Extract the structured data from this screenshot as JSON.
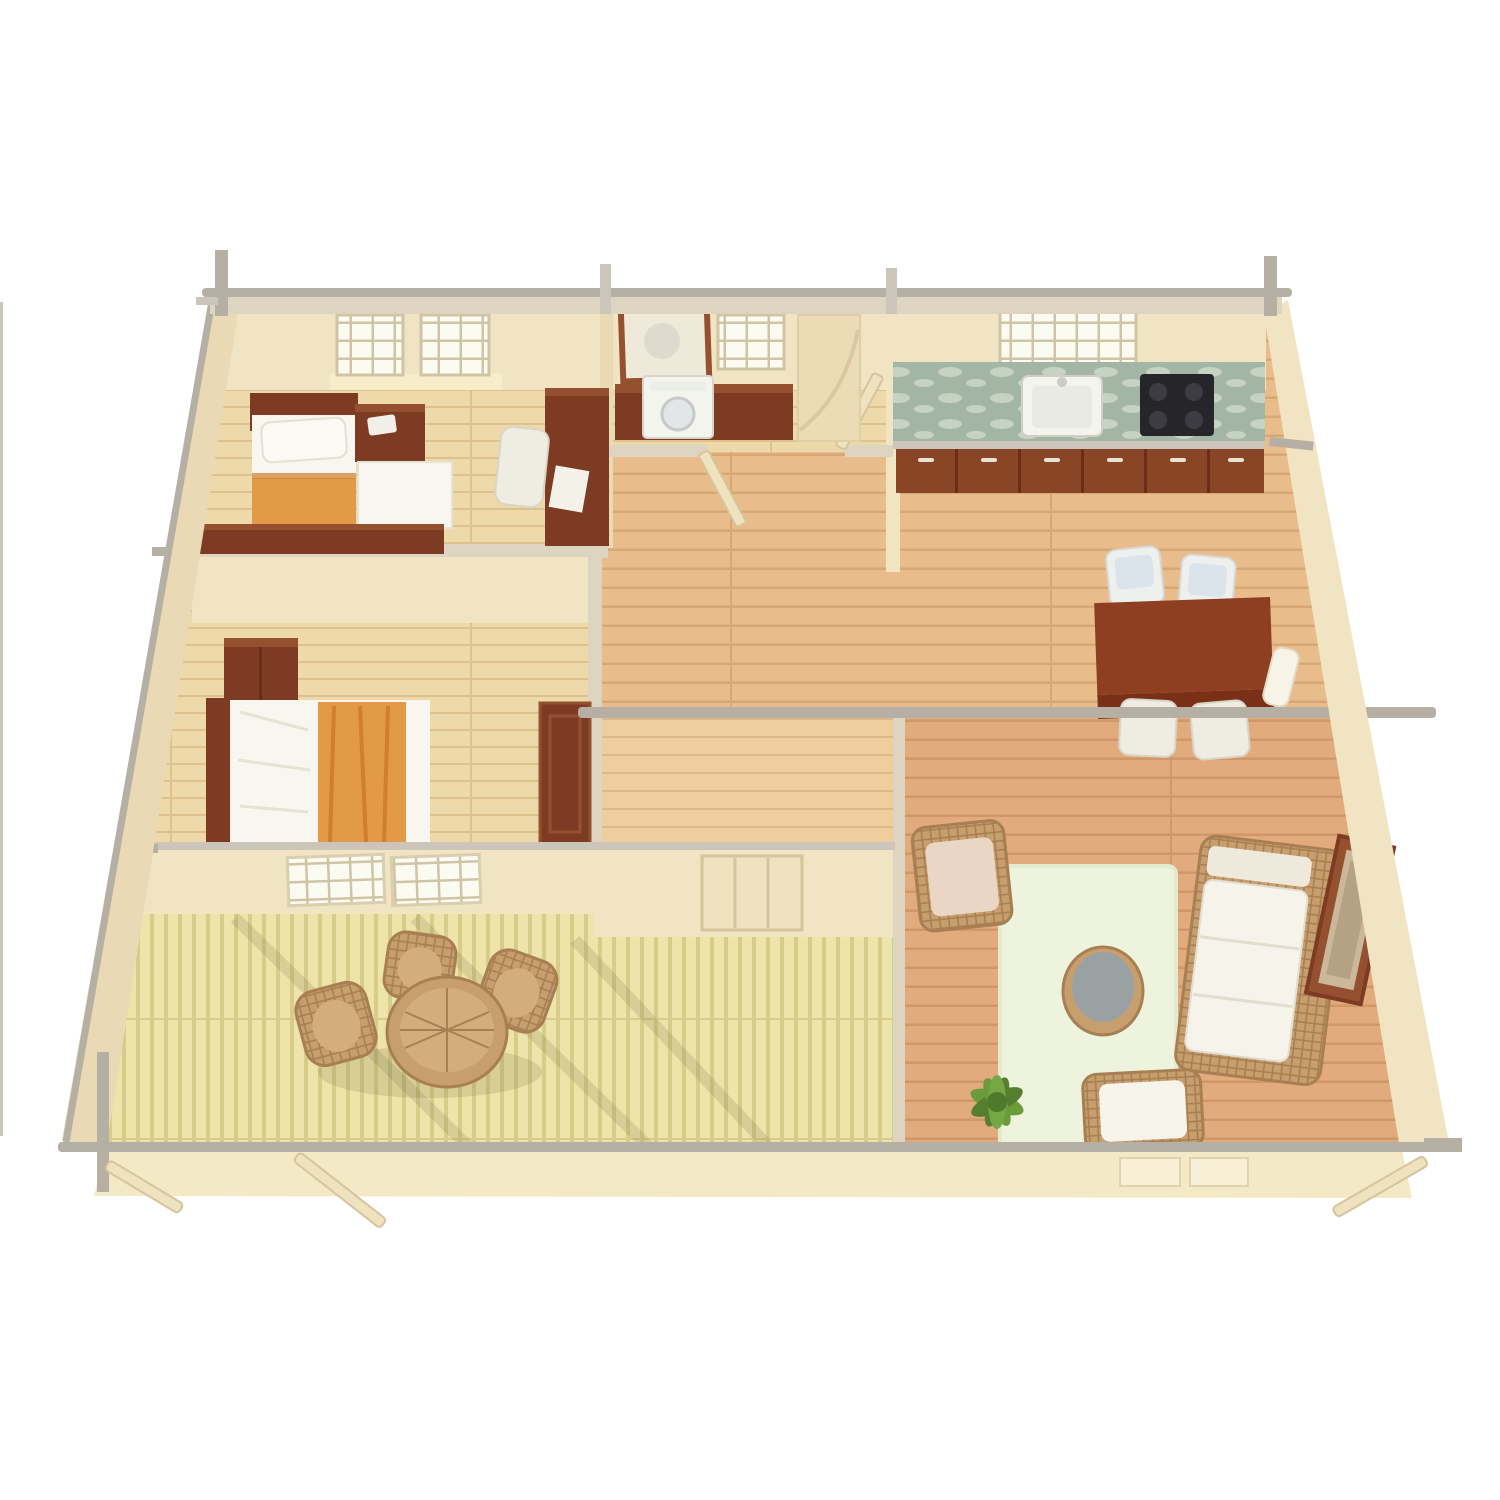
{
  "scene": {
    "kind": "isometric-floor-plan-render",
    "rooms": [
      "bedroom-back",
      "utility-room",
      "kitchen",
      "bedroom-front",
      "hallway",
      "dining-area",
      "mudroom",
      "living-room",
      "terrace"
    ],
    "furniture": [
      "single-bed",
      "guest-mattress",
      "nightstand-chest",
      "desk",
      "desk-chair",
      "mirror",
      "washing-machine",
      "dresser-counter",
      "kitchen-counter",
      "sink",
      "cooktop",
      "base-cabinets",
      "double-bed",
      "wardrobe",
      "bedroom-door",
      "dining-table",
      "dining-chairs",
      "wall-sconce",
      "area-rug",
      "coffee-table",
      "wicker-sofa",
      "wicker-armchair",
      "lounge-chair",
      "potted-plant",
      "picture-frame",
      "terrace-table",
      "terrace-chairs",
      "closet-doors",
      "mudroom-door"
    ]
  },
  "palette": {
    "background": "#ffffff",
    "wall_face": "#f0e4c2",
    "wall_face_shaded": "#e9d9b4",
    "wall_top": "#ddd5c2",
    "beam_gray": "#b6afa4",
    "beam_light": "#ccc5b9",
    "floor_bedroom": "#eed9ab",
    "plank_line_bedroom": "#ddc28f",
    "floor_hall": "#e9bd8b",
    "plank_line_hall": "#d7a876",
    "floor_living": "#e2ab7d",
    "plank_line_living": "#d09768",
    "floor_small": "#eecd9e",
    "plank_line_small": "#ddb988",
    "deck_base": "#ece4a8",
    "deck_stripe": "#d8cc8a",
    "wood_dark": "#7d3b24",
    "wood_mid": "#95512f",
    "wood_deep": "#6b2d17",
    "linen_white": "#f8f6ef",
    "linen_shade": "#e6e2d4",
    "blanket_orange": "#e29a49",
    "blanket_orange_deep": "#cf7f2e",
    "counter_marble": "#a3b5a4",
    "marble_light": "#c6d2c2",
    "sink_white": "#f4f4ee",
    "cooktop_black": "#26262a",
    "cabinet_brown": "#8a4527",
    "window_glass": "#fcfbf2",
    "window_mullion": "#cfc5a5",
    "window_glow": "#f9efcb",
    "wicker": "#c79f6f",
    "wicker_dark": "#a87f52",
    "wicker_light": "#d3ae7c",
    "cushion_white": "#f6f3ea",
    "cushion_pink": "#e9d6c4",
    "cushion_blue": "#dbe4ea",
    "rug": "#eef3dd",
    "rug_border": "#e2ead0",
    "table_gray": "#9aa1a3",
    "plant_green": "#6a9c3c",
    "plant_green_dark": "#557f2e",
    "door_cream": "#efe2bf",
    "door_edge": "#d6c49c",
    "shadow": "rgba(90,75,40,0.14)"
  }
}
